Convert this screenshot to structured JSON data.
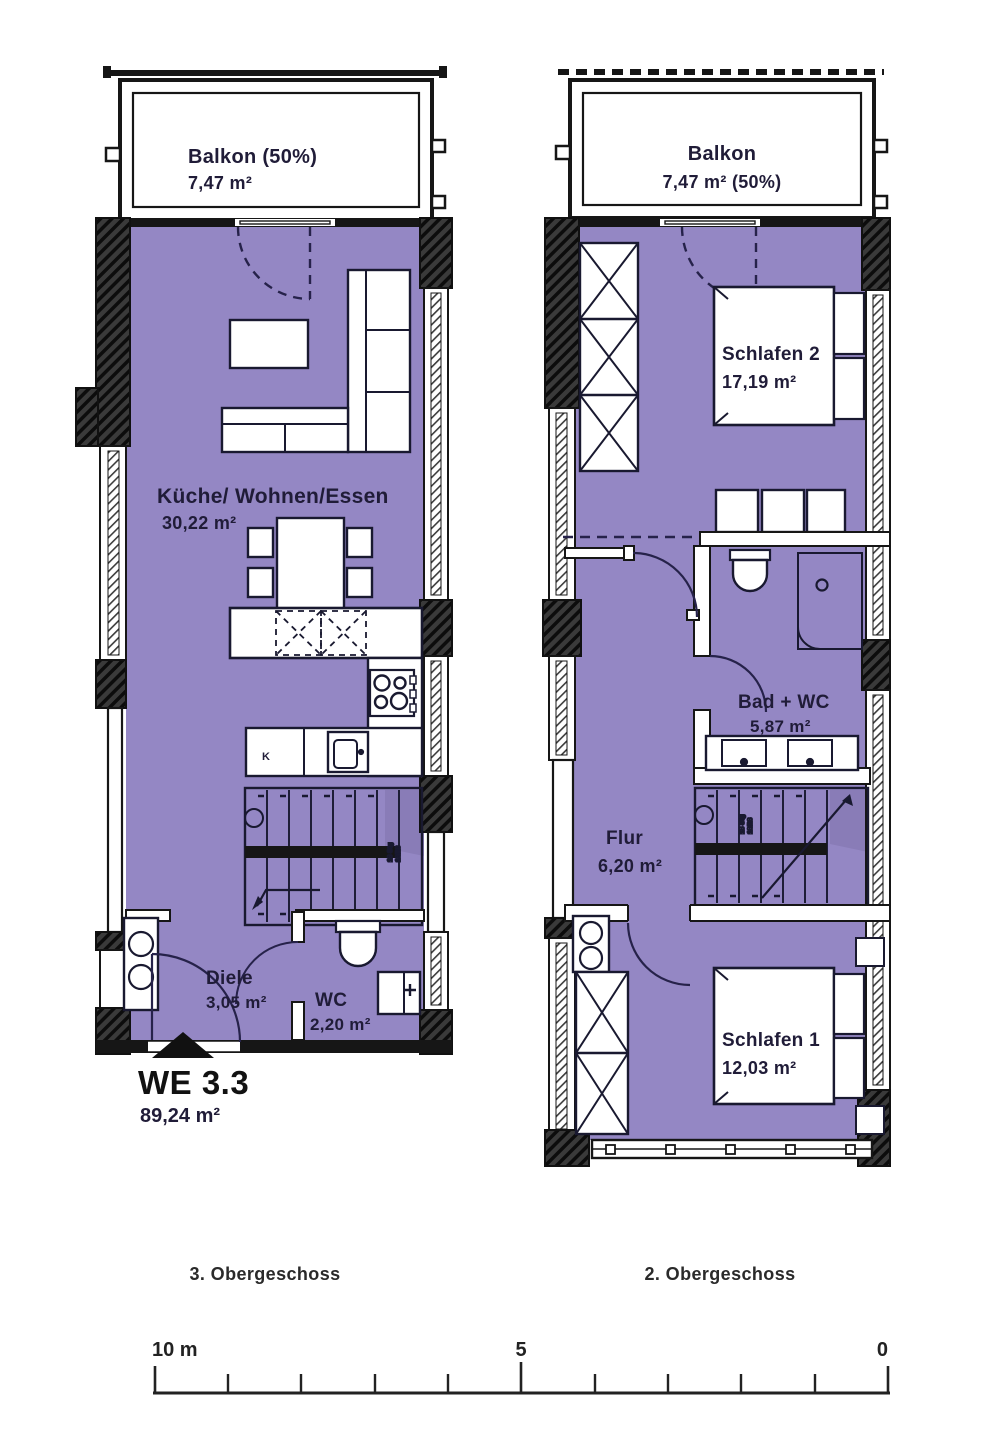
{
  "left": {
    "title": "3. Obergeschoss",
    "balcony_name": "Balkon (50%)",
    "balcony_area": "7,47 m²",
    "living_name": "Küche/ Wohnen/Essen",
    "living_area": "30,22 m²",
    "diele_name": "Diele",
    "diele_area": "3,05 m²",
    "wc_name": "WC",
    "wc_area": "2,20 m²",
    "kitchen_k": "K",
    "stair_note_1": "18 Stg",
    "stair_note_2": "18/28",
    "unit_id": "WE 3.3",
    "unit_area": "89,24 m²"
  },
  "right": {
    "title": "2. Obergeschoss",
    "balcony_name": "Balkon",
    "balcony_area": "7,47 m² (50%)",
    "schlafen2_name": "Schlafen 2",
    "schlafen2_area": "17,19 m²",
    "bad_name": "Bad + WC",
    "bad_area": "5,87 m²",
    "flur_name": "Flur",
    "flur_area": "6,20 m²",
    "schlafen1_name": "Schlafen 1",
    "schlafen1_area": "12,03 m²",
    "stair_note_1": "18 Stg",
    "stair_note_2": "18/28"
  },
  "scale": {
    "left_label": "10 m",
    "mid_label": "5",
    "right_label": "0"
  },
  "colors": {
    "room_fill": "#9487C4",
    "room_shade": "#897CB7",
    "wall": "#161616",
    "text": "#201C38"
  }
}
